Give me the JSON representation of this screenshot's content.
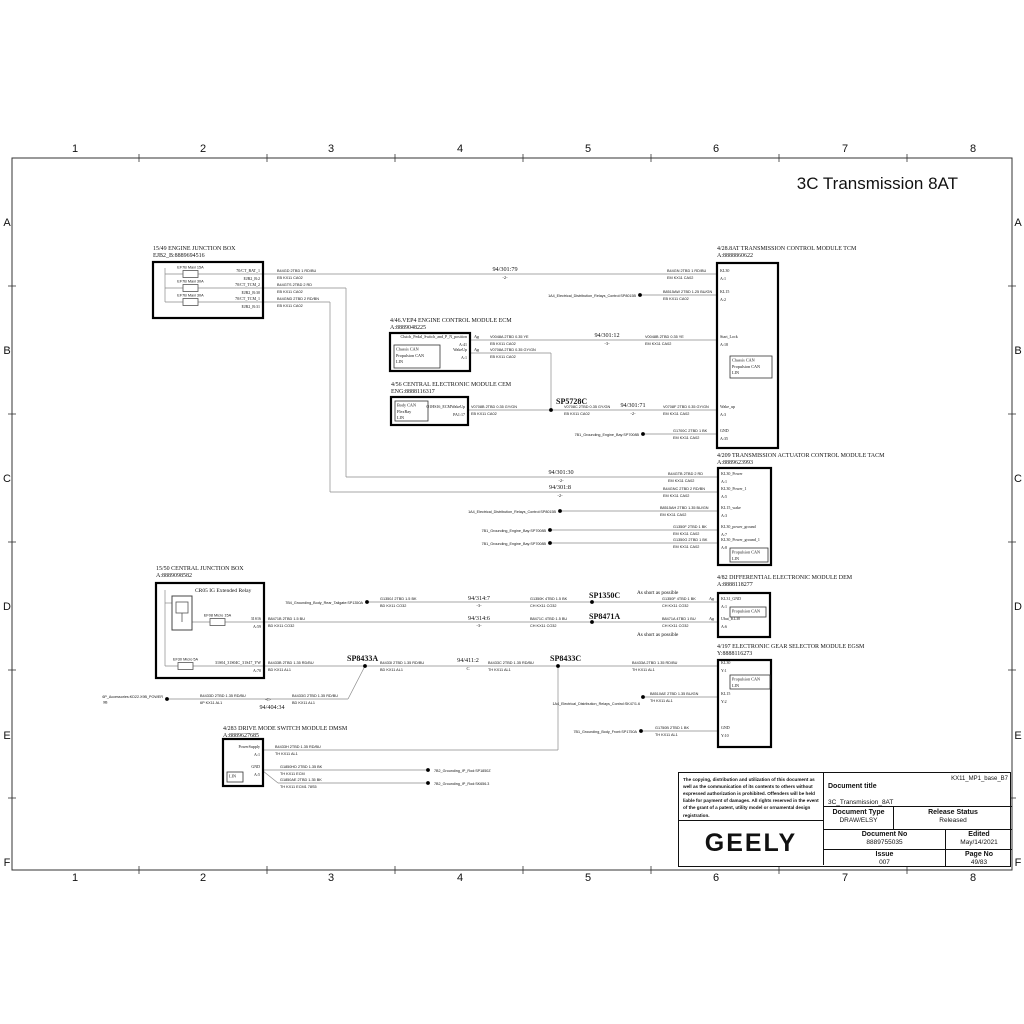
{
  "sheet": {
    "title": "3C Transmission 8AT",
    "cols": [
      "1",
      "2",
      "3",
      "4",
      "5",
      "6",
      "7",
      "8"
    ],
    "col_x": [
      75,
      203,
      331,
      460,
      588,
      716,
      845,
      973
    ],
    "col_ticks": [
      139,
      267,
      395,
      523,
      651,
      779,
      907
    ],
    "rows": [
      "A",
      "B",
      "C",
      "D",
      "E",
      "F"
    ],
    "row_y": [
      222,
      350,
      478,
      606,
      735,
      862
    ],
    "row_ticks": [
      286,
      414,
      542,
      670,
      798
    ],
    "frame": {
      "x": 12,
      "y": 158,
      "w": 1000,
      "h": 712
    }
  },
  "title_block": {
    "legal": "The copying, distribution and utilization of this document as well as the communication of its contents to others without expressed authorization is prohibited. Offenders will be held liable for payment of damages. All rights reserved in the event of the grant of a patent, utility model or ornamental design registration.",
    "brand": "GEELY",
    "doc_title_label": "Document title",
    "variant": "KX11_MP1_base_B7",
    "doc_title": "3C_Transmission_8AT",
    "doc_type_label": "Document Type",
    "doc_type": "DRAW/ELSY",
    "release_label": "Release Status",
    "release": "Released",
    "doc_no_label": "Document No",
    "doc_no": "8889755035",
    "edited_label": "Edited",
    "edited": "May/14/2021",
    "issue_label": "Issue",
    "issue": "007",
    "page_label": "Page No",
    "page": "49/83"
  },
  "modules": [
    {
      "id": "ejb",
      "header": [
        "15/49    ENGINE JUNCTION BOX",
        "EJB2_B:8889694516"
      ],
      "hx": 153,
      "hy": 250,
      "box": [
        153,
        262,
        110,
        56
      ],
      "pins": [
        {
          "name": "70/CT_BAT_1",
          "num": "EJB2_B:2",
          "y": 274,
          "side": "right"
        },
        {
          "name": "70/CT_TCM_2",
          "num": "EJB2_B:30",
          "y": 288,
          "side": "right"
        },
        {
          "name": "70/CT_TCM_1",
          "num": "EJB2_B:31",
          "y": 302,
          "side": "right"
        }
      ],
      "fuses": [
        {
          "label": "EF7B Maxi 15A",
          "x": 183,
          "y": 274
        },
        {
          "label": "EF7B Maxi 30A",
          "x": 183,
          "y": 288
        },
        {
          "label": "EF7B Maxi 30A",
          "x": 183,
          "y": 302
        }
      ]
    },
    {
      "id": "tcm",
      "header": [
        "4/28.8AT    TRANSMISSION CONTROL MODULE TCM",
        "A:8888860622"
      ],
      "hx": 717,
      "hy": 250,
      "box": [
        717,
        263,
        61,
        185
      ],
      "pins": [
        {
          "name": "KL30",
          "num": "A:1",
          "y": 274,
          "side": "left"
        },
        {
          "name": "KL15",
          "num": "A:2",
          "y": 295,
          "side": "left"
        },
        {
          "name": "Start_Lock",
          "num": "A:18",
          "y": 340,
          "side": "left"
        },
        {
          "name": "Wake_up",
          "num": "A:3",
          "y": 410,
          "side": "left"
        },
        {
          "name": "GND",
          "num": "A:35",
          "y": 434,
          "side": "left"
        }
      ],
      "inner": [
        {
          "box": [
            730,
            356,
            42,
            22
          ],
          "lines": [
            "Chassis CAN",
            "Propulsion CAN",
            "LIN"
          ]
        }
      ]
    },
    {
      "id": "ecm",
      "header": [
        "4/46.VEP4    ENGINE CONTROL MODULE ECM",
        "A:8889048225"
      ],
      "hx": 390,
      "hy": 322,
      "box": [
        390,
        333,
        80,
        38
      ],
      "pins": [
        {
          "name": "Clutch_Pedal_Switch_and_P_N_position",
          "num": "A:41",
          "y": 340,
          "side": "right"
        },
        {
          "name": "WakeUp",
          "num": "A:1",
          "y": 353,
          "side": "right"
        }
      ],
      "inner": [
        {
          "box": [
            394,
            345,
            46,
            23
          ],
          "lines": [
            "Chassis CAN",
            "Propulsion CAN",
            "LIN"
          ]
        }
      ]
    },
    {
      "id": "cem",
      "header": [
        "4/56    CENTRAL ELECTRONIC MODULE CEM",
        "ENG:8888116317"
      ],
      "hx": 391,
      "hy": 386,
      "box": [
        391,
        397,
        77,
        28
      ],
      "pins": [
        {
          "name": "O1HS16_ECMWakeUp",
          "num": "PA1:17",
          "y": 410,
          "side": "right"
        }
      ],
      "inner": [
        {
          "box": [
            395,
            401,
            33,
            20
          ],
          "lines": [
            "Body CAN",
            "FlexRay",
            "LIN"
          ]
        }
      ]
    },
    {
      "id": "tacm",
      "header": [
        "4/209    TRANSMISSION ACTUATOR CONTROL MODULE TACM",
        "A:8889623993"
      ],
      "hx": 717,
      "hy": 457,
      "box": [
        718,
        468,
        53,
        97
      ],
      "pins": [
        {
          "name": "KL30_Power",
          "num": "A:1",
          "y": 477,
          "side": "left"
        },
        {
          "name": "KL30_Power_1",
          "num": "A:5",
          "y": 492,
          "side": "left"
        },
        {
          "name": "KL15_wake",
          "num": "A:3",
          "y": 511,
          "side": "left"
        },
        {
          "name": "KL30_power_ground",
          "num": "A:7",
          "y": 530,
          "side": "left"
        },
        {
          "name": "KL30_Power_ground_1",
          "num": "A:8",
          "y": 543,
          "side": "left"
        }
      ],
      "inner": [
        {
          "box": [
            730,
            548,
            38,
            14
          ],
          "lines": [
            "Propulsion CAN",
            "LIN"
          ]
        }
      ]
    },
    {
      "id": "cjb",
      "header": [
        "15/50    CENTRAL JUNCTION BOX",
        "A:8889098582"
      ],
      "hx": 156,
      "hy": 570,
      "box": [
        156,
        583,
        108,
        95
      ],
      "pins": [
        {
          "name": "31S16",
          "num": "A:59",
          "y": 622,
          "side": "right"
        },
        {
          "name": "31S04_31S04C_31S47_YW",
          "num": "A:70",
          "y": 666,
          "side": "right"
        }
      ],
      "fuses": [
        {
          "label": "EF08 Micro 15A",
          "x": 210,
          "y": 622
        },
        {
          "label": "EF30 Micro 5A",
          "x": 178,
          "y": 666
        }
      ],
      "relay": {
        "label": "CR05 IG Extended Relay",
        "lx": 195,
        "ly": 592
      }
    },
    {
      "id": "dem",
      "header": [
        "4/82    DIFFERENTIAL ELECTRONIC MODULE DEM",
        "A:8888118277"
      ],
      "hx": 717,
      "hy": 579,
      "box": [
        718,
        593,
        52,
        44
      ],
      "pins": [
        {
          "name": "KL31_GND",
          "num": "A:1",
          "y": 602,
          "side": "left"
        },
        {
          "name": "Ubat_KL30",
          "num": "A:6",
          "y": 622,
          "side": "left"
        }
      ],
      "inner": [
        {
          "box": [
            730,
            607,
            36,
            10
          ],
          "lines": [
            "Propulsion CAN"
          ]
        }
      ]
    },
    {
      "id": "egsm",
      "header": [
        "4/197    ELECTRONIC GEAR SELECTOR MODULE EGSM",
        "Y:8888116273"
      ],
      "hx": 717,
      "hy": 648,
      "box": [
        718,
        660,
        53,
        87
      ],
      "pins": [
        {
          "name": "KL30",
          "num": "Y:1",
          "y": 666,
          "side": "left"
        },
        {
          "name": "KL15",
          "num": "Y:2",
          "y": 697,
          "side": "left"
        },
        {
          "name": "GND",
          "num": "Y:10",
          "y": 731,
          "side": "left"
        }
      ],
      "inner": [
        {
          "box": [
            730,
            675,
            40,
            14
          ],
          "lines": [
            "Propulsion CAN",
            "LIN"
          ]
        }
      ]
    },
    {
      "id": "dmsm",
      "header": [
        "4/283    DRIVE MODE SWITCH MODULE DMSM",
        "A:8889627685"
      ],
      "hx": 223,
      "hy": 730,
      "box": [
        223,
        739,
        40,
        47
      ],
      "pins": [
        {
          "name": "PowerSupply",
          "num": "A:1",
          "y": 750,
          "side": "right"
        },
        {
          "name": "GND",
          "num": "A:5",
          "y": 770,
          "side": "right"
        }
      ],
      "inner": [
        {
          "box": [
            227,
            772,
            16,
            10
          ],
          "lines": [
            "LIN"
          ]
        }
      ]
    }
  ],
  "wires": {
    "segments": [
      [
        165,
        268,
        165,
        302
      ],
      [
        165,
        274,
        717,
        274
      ],
      [
        165,
        288,
        346,
        288
      ],
      [
        346,
        288,
        346,
        477
      ],
      [
        346,
        477,
        718,
        477
      ],
      [
        165,
        302,
        330,
        302
      ],
      [
        330,
        302,
        330,
        492
      ],
      [
        330,
        492,
        718,
        492
      ],
      [
        640,
        295,
        717,
        295
      ],
      [
        470,
        340,
        717,
        340
      ],
      [
        470,
        353,
        551,
        353
      ],
      [
        551,
        353,
        551,
        410
      ],
      [
        468,
        410,
        717,
        410
      ],
      [
        643,
        434,
        717,
        434
      ],
      [
        560,
        511,
        718,
        511
      ],
      [
        550,
        530,
        718,
        530
      ],
      [
        550,
        543,
        718,
        543
      ],
      [
        367,
        602,
        718,
        602
      ],
      [
        192,
        622,
        718,
        622
      ],
      [
        165,
        666,
        718,
        666
      ],
      [
        167,
        699,
        348,
        699
      ],
      [
        348,
        699,
        365,
        666
      ],
      [
        263,
        750,
        558,
        750
      ],
      [
        558,
        750,
        558,
        666
      ],
      [
        643,
        697,
        718,
        697
      ],
      [
        641,
        731,
        718,
        731
      ],
      [
        263,
        770,
        428,
        770
      ],
      [
        263,
        771,
        278,
        783
      ],
      [
        278,
        783,
        428,
        783
      ],
      [
        165,
        590,
        165,
        666
      ],
      [
        165,
        603,
        172,
        603
      ]
    ],
    "dots": [
      [
        640,
        295
      ],
      [
        551,
        410
      ],
      [
        643,
        434
      ],
      [
        560,
        511
      ],
      [
        550,
        530
      ],
      [
        550,
        543
      ],
      [
        367,
        602
      ],
      [
        592,
        602
      ],
      [
        592,
        622
      ],
      [
        365,
        666
      ],
      [
        558,
        666
      ],
      [
        167,
        699
      ],
      [
        643,
        697
      ],
      [
        641,
        731
      ],
      [
        428,
        770
      ],
      [
        428,
        783
      ]
    ]
  },
  "junctions": [
    {
      "t": "SP5728C",
      "x": 556,
      "y": 404
    },
    {
      "t": "SP1350C",
      "x": 589,
      "y": 598
    },
    {
      "t": "SP8471A",
      "x": 589,
      "y": 619
    },
    {
      "t": "SP8433A",
      "x": 347,
      "y": 661
    },
    {
      "t": "SP8433C",
      "x": 550,
      "y": 661
    }
  ],
  "net_refs": [
    {
      "t": "94/301:79",
      "x": 505,
      "y": 271,
      "s": "-2-",
      "sx": 505,
      "sy": 279
    },
    {
      "t": "94/301:12",
      "x": 607,
      "y": 337,
      "s": "-3-",
      "sx": 607,
      "sy": 345
    },
    {
      "t": "94/301:71",
      "x": 633,
      "y": 407,
      "s": "-2-",
      "sx": 633,
      "sy": 415
    },
    {
      "t": "94/301:30",
      "x": 561,
      "y": 474,
      "s": "-2-",
      "sx": 561,
      "sy": 482
    },
    {
      "t": "94/301:8",
      "x": 560,
      "y": 489,
      "s": "-2-",
      "sx": 560,
      "sy": 497
    },
    {
      "t": "94/314:7",
      "x": 479,
      "y": 600,
      "s": "-3-",
      "sx": 479,
      "sy": 607
    },
    {
      "t": "94/314:6",
      "x": 479,
      "y": 620,
      "s": "-3-",
      "sx": 479,
      "sy": 627
    },
    {
      "t": "94/411:2",
      "x": 468,
      "y": 662,
      "s": "C",
      "sx": 468,
      "sy": 670
    },
    {
      "t": "94/404:34",
      "x": 272,
      "y": 709,
      "s": "-C-",
      "sx": 268,
      "sy": 701
    }
  ],
  "wire_labels": [
    {
      "x": 277,
      "y": 274,
      "l1": "B44GD 2TBD 1 RD/BU",
      "l2": "EB KX11 CA02"
    },
    {
      "x": 667,
      "y": 274,
      "l1": "B44GN 2TBD 1 RD/BU",
      "l2": "EM KX11 CA02"
    },
    {
      "x": 277,
      "y": 288,
      "l1": "B44GTS 2TBD 2 RD",
      "l2": "EB KX11 CA02"
    },
    {
      "x": 277,
      "y": 302,
      "l1": "B44GND 2TBD 2 RD/BN",
      "l2": "EB KX11 CA02"
    },
    {
      "x": 663,
      "y": 295,
      "l1": "B8515AW 2TBD 1.25 BU/GN",
      "l2": "EB KX11 CA02"
    },
    {
      "x": 490,
      "y": 340,
      "l1": "V0048A 2TBD 0.35 YE",
      "l2": "EB KX11 CA02"
    },
    {
      "x": 645,
      "y": 340,
      "l1": "V0048B 2TBD 0.35 YE",
      "l2": "EM KX11 CA02"
    },
    {
      "x": 490,
      "y": 353,
      "l1": "V0708A 2TBD 0.35 GY/GN",
      "l2": "EB KX11 CA02"
    },
    {
      "x": 471,
      "y": 410,
      "l1": "V0708B 2TBD 0.35 GY/GN",
      "l2": "EB KX11 CA02"
    },
    {
      "x": 564,
      "y": 410,
      "l1": "V0708C 2TBD 0.35 GY/GN",
      "l2": "EB KX11 CA02"
    },
    {
      "x": 663,
      "y": 410,
      "l1": "V0708F 2TBD 0.35 GY/GN",
      "l2": "EM KX11 CA02"
    },
    {
      "x": 673,
      "y": 434,
      "l1": "G1700C 2TBD 1 BK",
      "l2": "EM KX11 CA02"
    },
    {
      "x": 668,
      "y": 477,
      "l1": "B44GTB 2TBD 2 RD",
      "l2": "EM KX11 CA02"
    },
    {
      "x": 663,
      "y": 492,
      "l1": "B44GNC 2TBD 2 RD/BN",
      "l2": "EM KX11 CA02"
    },
    {
      "x": 660,
      "y": 511,
      "l1": "B8515AH 2TBD 1.35 BU/GN",
      "l2": "EM KX11 CA02"
    },
    {
      "x": 673,
      "y": 530,
      "l1": "G1350F 2TBD 1 BK",
      "l2": "EM KX11 CA02"
    },
    {
      "x": 673,
      "y": 543,
      "l1": "G1350G 2TBD 1 BK",
      "l2": "EM KX11 CA02"
    },
    {
      "x": 380,
      "y": 602,
      "l1": "G1350J 2TBD 1.5 BK",
      "l2": "BD KX11 CO32"
    },
    {
      "x": 530,
      "y": 602,
      "l1": "G1350K 4TBD 1.5 BK",
      "l2": "CH KX11 CO32"
    },
    {
      "x": 662,
      "y": 602,
      "l1": "G1350F 4TBD 1 BK",
      "l2": "CH KX11 CO32"
    },
    {
      "x": 268,
      "y": 622,
      "l1": "B8471B 2TBD 1.5 BU",
      "l2": "BD KX11 CO32"
    },
    {
      "x": 530,
      "y": 622,
      "l1": "B8471C 4TBD 1.5 BU",
      "l2": "CH KX11 CO32"
    },
    {
      "x": 662,
      "y": 622,
      "l1": "B8471A 4TBD 1 BU",
      "l2": "CH KX11 CO32"
    },
    {
      "x": 268,
      "y": 666,
      "l1": "B4433B 2TBD 1.35 RD/BU",
      "l2": "BD KX11 AL1"
    },
    {
      "x": 380,
      "y": 666,
      "l1": "B4433I 2TBD 1.35 RD/BU",
      "l2": "BD KX11 AL1"
    },
    {
      "x": 488,
      "y": 666,
      "l1": "B4433C 2TBD 1.35 RD/BU",
      "l2": "TH KX11 AL1"
    },
    {
      "x": 632,
      "y": 666,
      "l1": "B4433A 2TBD 1.35 RD/BU",
      "l2": "TH KX11 AL1"
    },
    {
      "x": 200,
      "y": 699,
      "l1": "B4433D 2TBD 1.35 RD/BU",
      "l2": "6P KX11 AL1"
    },
    {
      "x": 292,
      "y": 699,
      "l1": "B4433G 2TBD 1.35 RD/BU",
      "l2": "BD KX11 AL1"
    },
    {
      "x": 650,
      "y": 697,
      "l1": "B8510AE 2TBD 1.35 BU/GN",
      "l2": "TH KX11 AL1"
    },
    {
      "x": 655,
      "y": 731,
      "l1": "G1750B 2TBD 1 BK",
      "l2": "TH KX11 AL1"
    },
    {
      "x": 275,
      "y": 750,
      "l1": "B4433H 2TBD 1.35 RD/BU",
      "l2": "TH KX11 AL1"
    },
    {
      "x": 280,
      "y": 770,
      "l1": "G1850HD 2TBD 1.35 BK",
      "l2": "TH KX11 ECM"
    },
    {
      "x": 280,
      "y": 783,
      "l1": "G1850AE 2TBD 1.35 BK",
      "l2": "TH KX11 ECM1 78S5"
    }
  ],
  "source_labels": [
    {
      "t": "1A4_Electrical_Distribution_Relays_Control:SP8015B",
      "x": 636,
      "y": 297,
      "a": "end"
    },
    {
      "t": "1A4_Electrical_Distribution_Relays_Control:SP8015B",
      "x": 556,
      "y": 513,
      "a": "end"
    },
    {
      "t": "7B1_Grounding_Engine_Bay:SP7008B",
      "x": 639,
      "y": 436,
      "a": "end"
    },
    {
      "t": "7B1_Grounding_Engine_Bay:SP7008B",
      "x": 546,
      "y": 532,
      "a": "end"
    },
    {
      "t": "7B1_Grounding_Engine_Bay:SP7008B",
      "x": 546,
      "y": 545,
      "a": "end"
    },
    {
      "t": "7B4_Grounding_Body_Rear_Tailgate:SP1350A",
      "x": 363,
      "y": 604,
      "a": "end"
    },
    {
      "t": "6P_Accessories:KD22.X9B_POWER",
      "t2": "9B",
      "x": 163,
      "y": 698,
      "a": "end"
    },
    {
      "t": "1A4_Electrical_Distribution_Relays_Control:SK47/1.6",
      "x": 640,
      "y": 705,
      "a": "end"
    },
    {
      "t": "7B1_Grounding_Body_Front:SP1750A",
      "x": 637,
      "y": 733,
      "a": "end"
    },
    {
      "t": "7B2_Grounding_IP_Rod:SP1850Z",
      "x": 434,
      "y": 772,
      "a": "start"
    },
    {
      "t": "7B2_Grounding_IP_Rod:SK656.3",
      "x": 434,
      "y": 785,
      "a": "start"
    }
  ],
  "notes": [
    {
      "t": "As short as possible",
      "x": 637,
      "y": 594
    },
    {
      "t": "As short as possible",
      "x": 637,
      "y": 636
    }
  ],
  "ag_label": "Ag",
  "ag_marks": [
    [
      474,
      338
    ],
    [
      474,
      351
    ],
    [
      709,
      600
    ],
    [
      709,
      620
    ]
  ],
  "colors": {
    "wire": "#8a8a8a",
    "box": "#000000",
    "text": "#111111",
    "frame": "#333333"
  }
}
